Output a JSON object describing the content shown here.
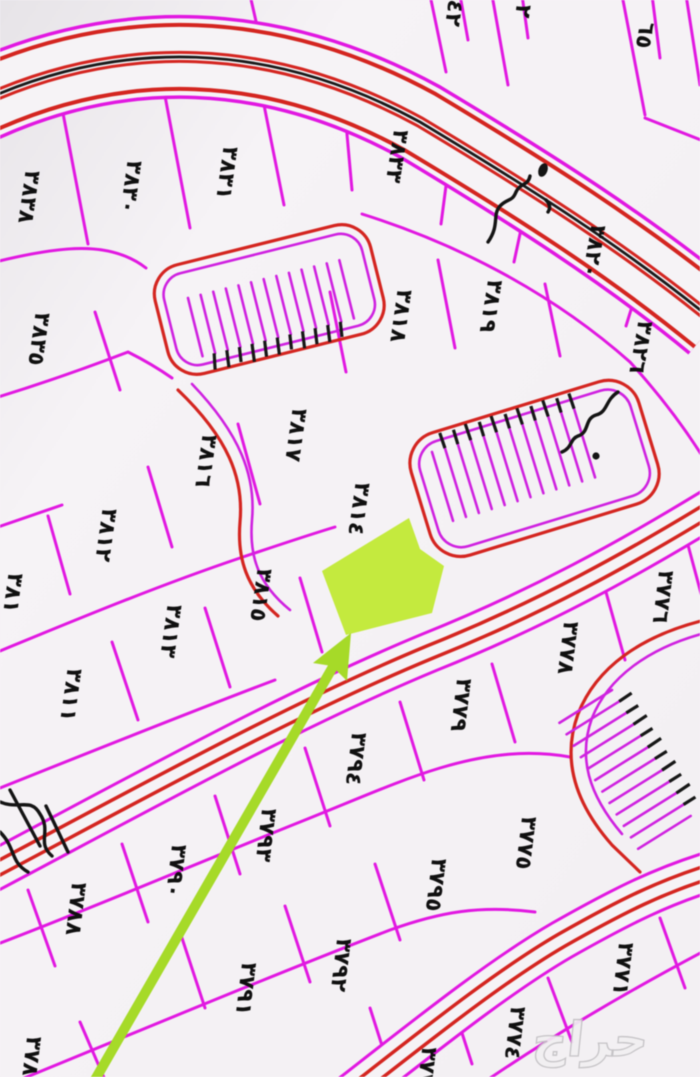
{
  "map": {
    "title": "cadastral-parcel-map",
    "watermark": "حراج",
    "colors": {
      "background": "#f5f2f5",
      "parcel_line": "#e118e1",
      "road_line": "#d42520",
      "road_centerline": "#1a1a1a",
      "label_text": "#101010",
      "highlight_plot": "#c4ea3e",
      "arrow": "#a6da28",
      "watermark_fill": "#f1eff1"
    },
    "highlight": {
      "kind": "selected-parcel",
      "marker": "green-arrow-pointing-to-green-plot"
    },
    "labels": [
      {
        "text": "٤٢",
        "x": 447,
        "y": 12,
        "rot": 98
      },
      {
        "text": "٢",
        "x": 516,
        "y": 10,
        "rot": 98
      },
      {
        "text": "٦٥",
        "x": 638,
        "y": 34,
        "rot": 100
      },
      {
        "text": "٣٨٣٨",
        "x": 22,
        "y": 196,
        "rot": 98
      },
      {
        "text": "٣٨٣٠",
        "x": 124,
        "y": 186,
        "rot": 98
      },
      {
        "text": "٣٨٣١",
        "x": 220,
        "y": 172,
        "rot": 98
      },
      {
        "text": "٣٨٣٣",
        "x": 390,
        "y": 155,
        "rot": 99
      },
      {
        "text": "٣٨٢٠",
        "x": 587,
        "y": 250,
        "rot": 100
      },
      {
        "text": "٣٨٢٦",
        "x": 634,
        "y": 346,
        "rot": 100
      },
      {
        "text": "٣٨٣٥",
        "x": 32,
        "y": 338,
        "rot": 98
      },
      {
        "text": "٣٨١٨",
        "x": 394,
        "y": 315,
        "rot": 98
      },
      {
        "text": "٣٨١٩",
        "x": 484,
        "y": 305,
        "rot": 99
      },
      {
        "text": "٣٨١٧",
        "x": 289,
        "y": 434,
        "rot": 98
      },
      {
        "text": "٣٨١٦",
        "x": 199,
        "y": 460,
        "rot": 98
      },
      {
        "text": "٣٨١٢",
        "x": 99,
        "y": 534,
        "rot": 98
      },
      {
        "text": "٣٨١",
        "x": 6,
        "y": 592,
        "rot": 98
      },
      {
        "text": "٣٨١٤",
        "x": 352,
        "y": 508,
        "rot": 98
      },
      {
        "text": "٣٨١٥",
        "x": 254,
        "y": 594,
        "rot": 98
      },
      {
        "text": "٣٨١٣",
        "x": 164,
        "y": 630,
        "rot": 98
      },
      {
        "text": "٣٨١١",
        "x": 64,
        "y": 694,
        "rot": 98
      },
      {
        "text": "٣٧٧٦",
        "x": 656,
        "y": 596,
        "rot": 97
      },
      {
        "text": "٣٧٧٨",
        "x": 561,
        "y": 647,
        "rot": 97
      },
      {
        "text": "٣٧٧٩",
        "x": 454,
        "y": 704,
        "rot": 97
      },
      {
        "text": "٣٧٩٤",
        "x": 349,
        "y": 758,
        "rot": 97
      },
      {
        "text": "٣٧٩٣",
        "x": 259,
        "y": 834,
        "rot": 97
      },
      {
        "text": "٣٧٩٠",
        "x": 169,
        "y": 870,
        "rot": 97
      },
      {
        "text": "٣٧٨٨",
        "x": 69,
        "y": 908,
        "rot": 97
      },
      {
        "text": "٣٧٩٥",
        "x": 429,
        "y": 884,
        "rot": 97
      },
      {
        "text": "٣٧٧٥",
        "x": 519,
        "y": 842,
        "rot": 97
      },
      {
        "text": "٣٧٧١",
        "x": 616,
        "y": 968,
        "rot": 97
      },
      {
        "text": "٣٧٧٤",
        "x": 508,
        "y": 1032,
        "rot": 97
      },
      {
        "text": "٣٧٩١",
        "x": 239,
        "y": 988,
        "rot": 97
      },
      {
        "text": "٣٧٩٢",
        "x": 334,
        "y": 964,
        "rot": 97
      },
      {
        "text": "٣٧٨٩",
        "x": 24,
        "y": 1062,
        "rot": 97
      },
      {
        "text": "٣٧٧",
        "x": 420,
        "y": 1066,
        "rot": 97
      },
      {
        "text": "٣٧",
        "x": 701,
        "y": 434,
        "rot": 97
      },
      {
        "text": "٣",
        "x": 700,
        "y": 918,
        "rot": 97
      }
    ]
  }
}
